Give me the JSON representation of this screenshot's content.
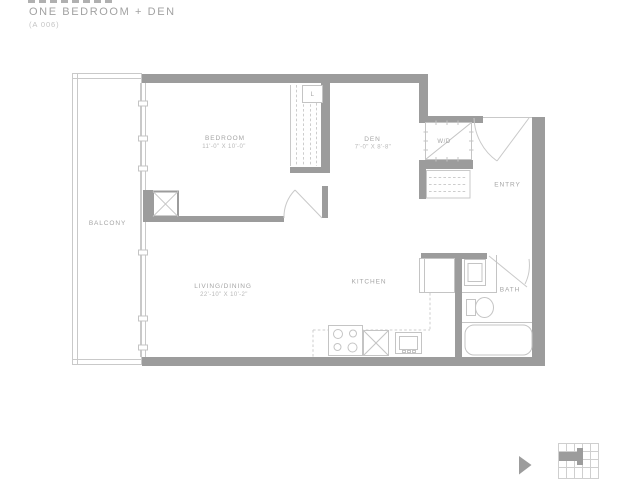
{
  "header": {
    "title": "ONE BEDROOM + DEN",
    "unit_code": "(A 006)"
  },
  "rooms": {
    "balcony": {
      "label": "BALCONY"
    },
    "bedroom": {
      "label": "BEDROOM",
      "dimensions": "11'-0\" X 10'-0\""
    },
    "den": {
      "label": "DEN",
      "dimensions": "7'-0\" X 8'-8\""
    },
    "living_dining": {
      "label": "LIVING/DINING",
      "dimensions": "22'-10\" X 10'-2\""
    },
    "kitchen": {
      "label": "KITCHEN"
    },
    "bath": {
      "label": "BATH"
    },
    "entry": {
      "label": "ENTRY"
    },
    "laundry": {
      "label": "W/D"
    },
    "linen_closet": {
      "label": "L"
    }
  },
  "icons": {
    "key_plan_icon": "mini-floorplate-locator-map",
    "cursor_icon": "pointer-triangle"
  },
  "colors": {
    "wall": "#9c9c9c",
    "thin_line": "#c9c9c9",
    "dashed_line": "#cdcdcd",
    "label_text": "#a5a5a5",
    "dimension_text": "#b8b8b8",
    "title_text": "#a2a2a2",
    "unit_code_text": "#c4c4c4"
  }
}
